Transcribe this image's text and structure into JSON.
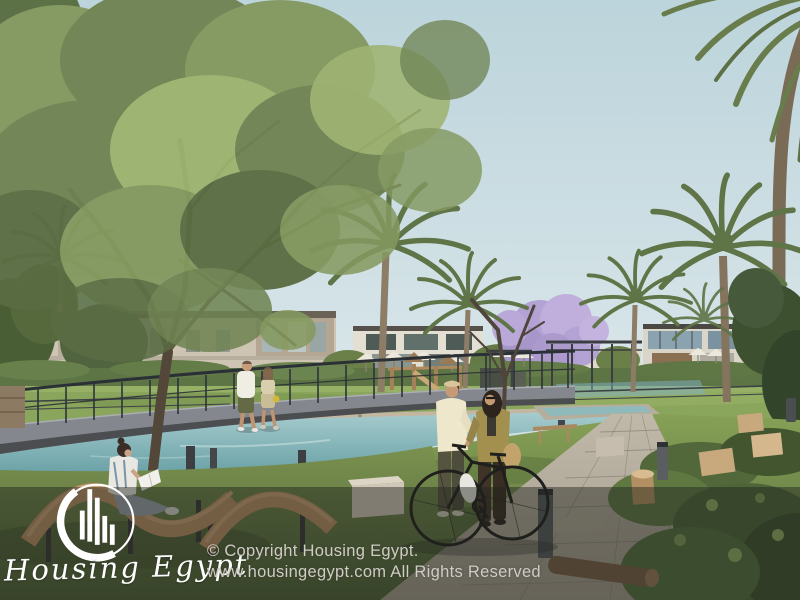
{
  "watermark": {
    "brand_name": "Housing Egypt",
    "logo_icon": "housing-egypt-buildings-circle-logo",
    "copyright_line1": "© Copyright Housing Egypt.",
    "copyright_line2": "www.housingegypt.com All Rights Reserved"
  },
  "scene": {
    "setting": "residential-compound-park-render",
    "objects": [
      "sky",
      "large-deciduous-tree",
      "palm-trees",
      "beige-townhouses",
      "modern-glass-villas",
      "jacaranda-purple-tree",
      "playground",
      "pergola",
      "white-umbrellas",
      "canal-water",
      "pebble-shore",
      "curved-bridge",
      "bridge-railing",
      "couple-walking-on-bridge",
      "woman-reading-on-lounge-chair",
      "wave-lounge-chairs",
      "man-and-woman-with-bicycle",
      "bicycle",
      "paved-stone-path",
      "bollard-lights",
      "stone-cube-bench",
      "water-basin",
      "planter-crates",
      "shrubs",
      "wood-log",
      "grass-lawn",
      "dark-bottom-overlay"
    ]
  },
  "palette": {
    "sky_top": "#bcd4db",
    "sky_bottom": "#dfeaec",
    "foliage_green": "#7e9459",
    "palm_green": "#617547",
    "grass_green": "#6f8448",
    "water_teal": "#7fb0b4",
    "house_beige": "#cdc4b4",
    "bridge_gray": "#84888e",
    "railing_dark": "#2d3339",
    "path_tan": "#b5ac9c",
    "jacaranda_purple": "#b3a2d4",
    "wood_brown": "#b98f63",
    "overlay_dark": "rgba(30,33,28,0.45)",
    "watermark_white": "#ffffff",
    "copyright_gray": "#cfccc5"
  }
}
